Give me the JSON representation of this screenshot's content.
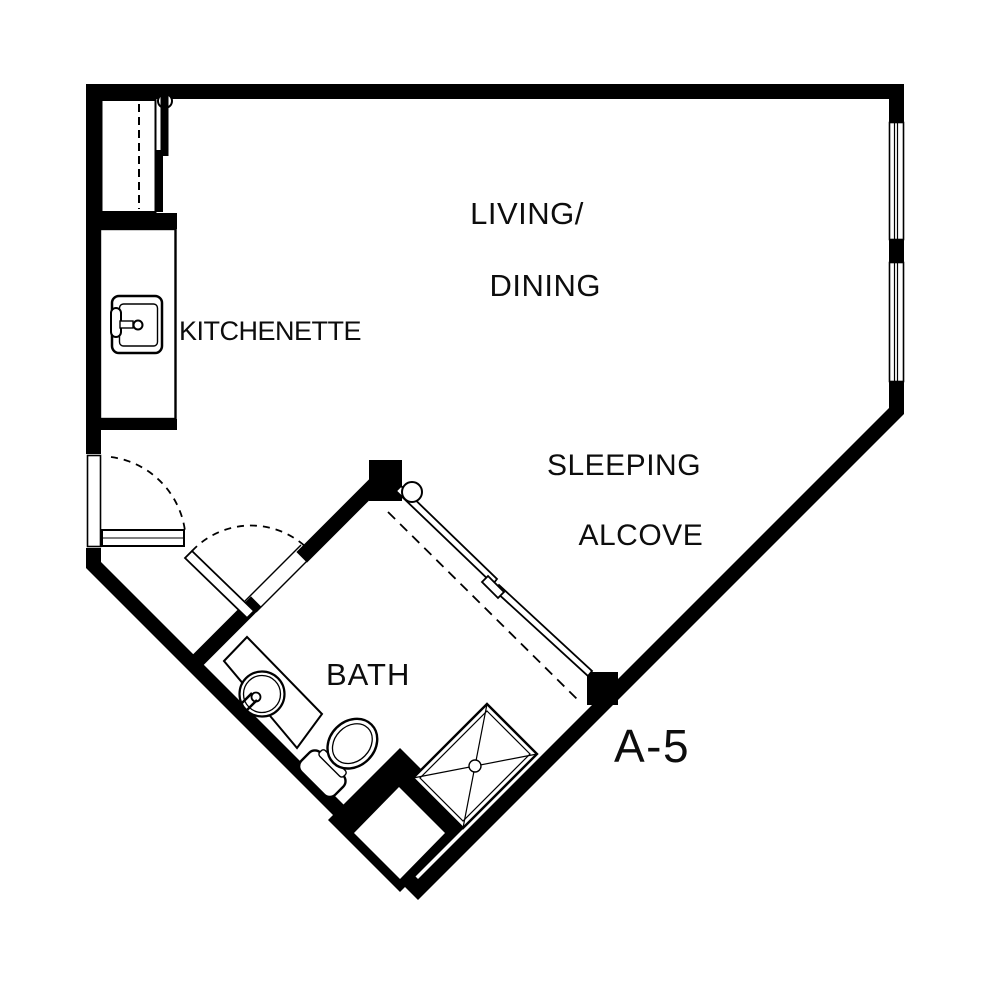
{
  "page": {
    "background": "#ffffff",
    "line_color": "#000000",
    "type": "apartment floor plan"
  },
  "unit": {
    "label": "A-5"
  },
  "rooms": {
    "living_dining": {
      "line1": "LIVING/",
      "line2": "DINING"
    },
    "kitchenette": {
      "label": "KITCHENETTE"
    },
    "sleeping_alcove": {
      "line1": "SLEEPING",
      "line2": "ALCOVE"
    },
    "bath": {
      "label": "BATH"
    }
  },
  "fixtures": {
    "kitchen_sink": "kitchen-sink",
    "bathroom_sink": "round-lavatory",
    "toilet": "toilet",
    "shower": "corner-shower",
    "entry_door": "entry-door-swing",
    "bath_door": "bath-door-swing",
    "closet": "closet-with-rod",
    "sliding_door": "bypass-sliding-doors",
    "windows": "double-window-pair",
    "niche": "corner-niche"
  }
}
